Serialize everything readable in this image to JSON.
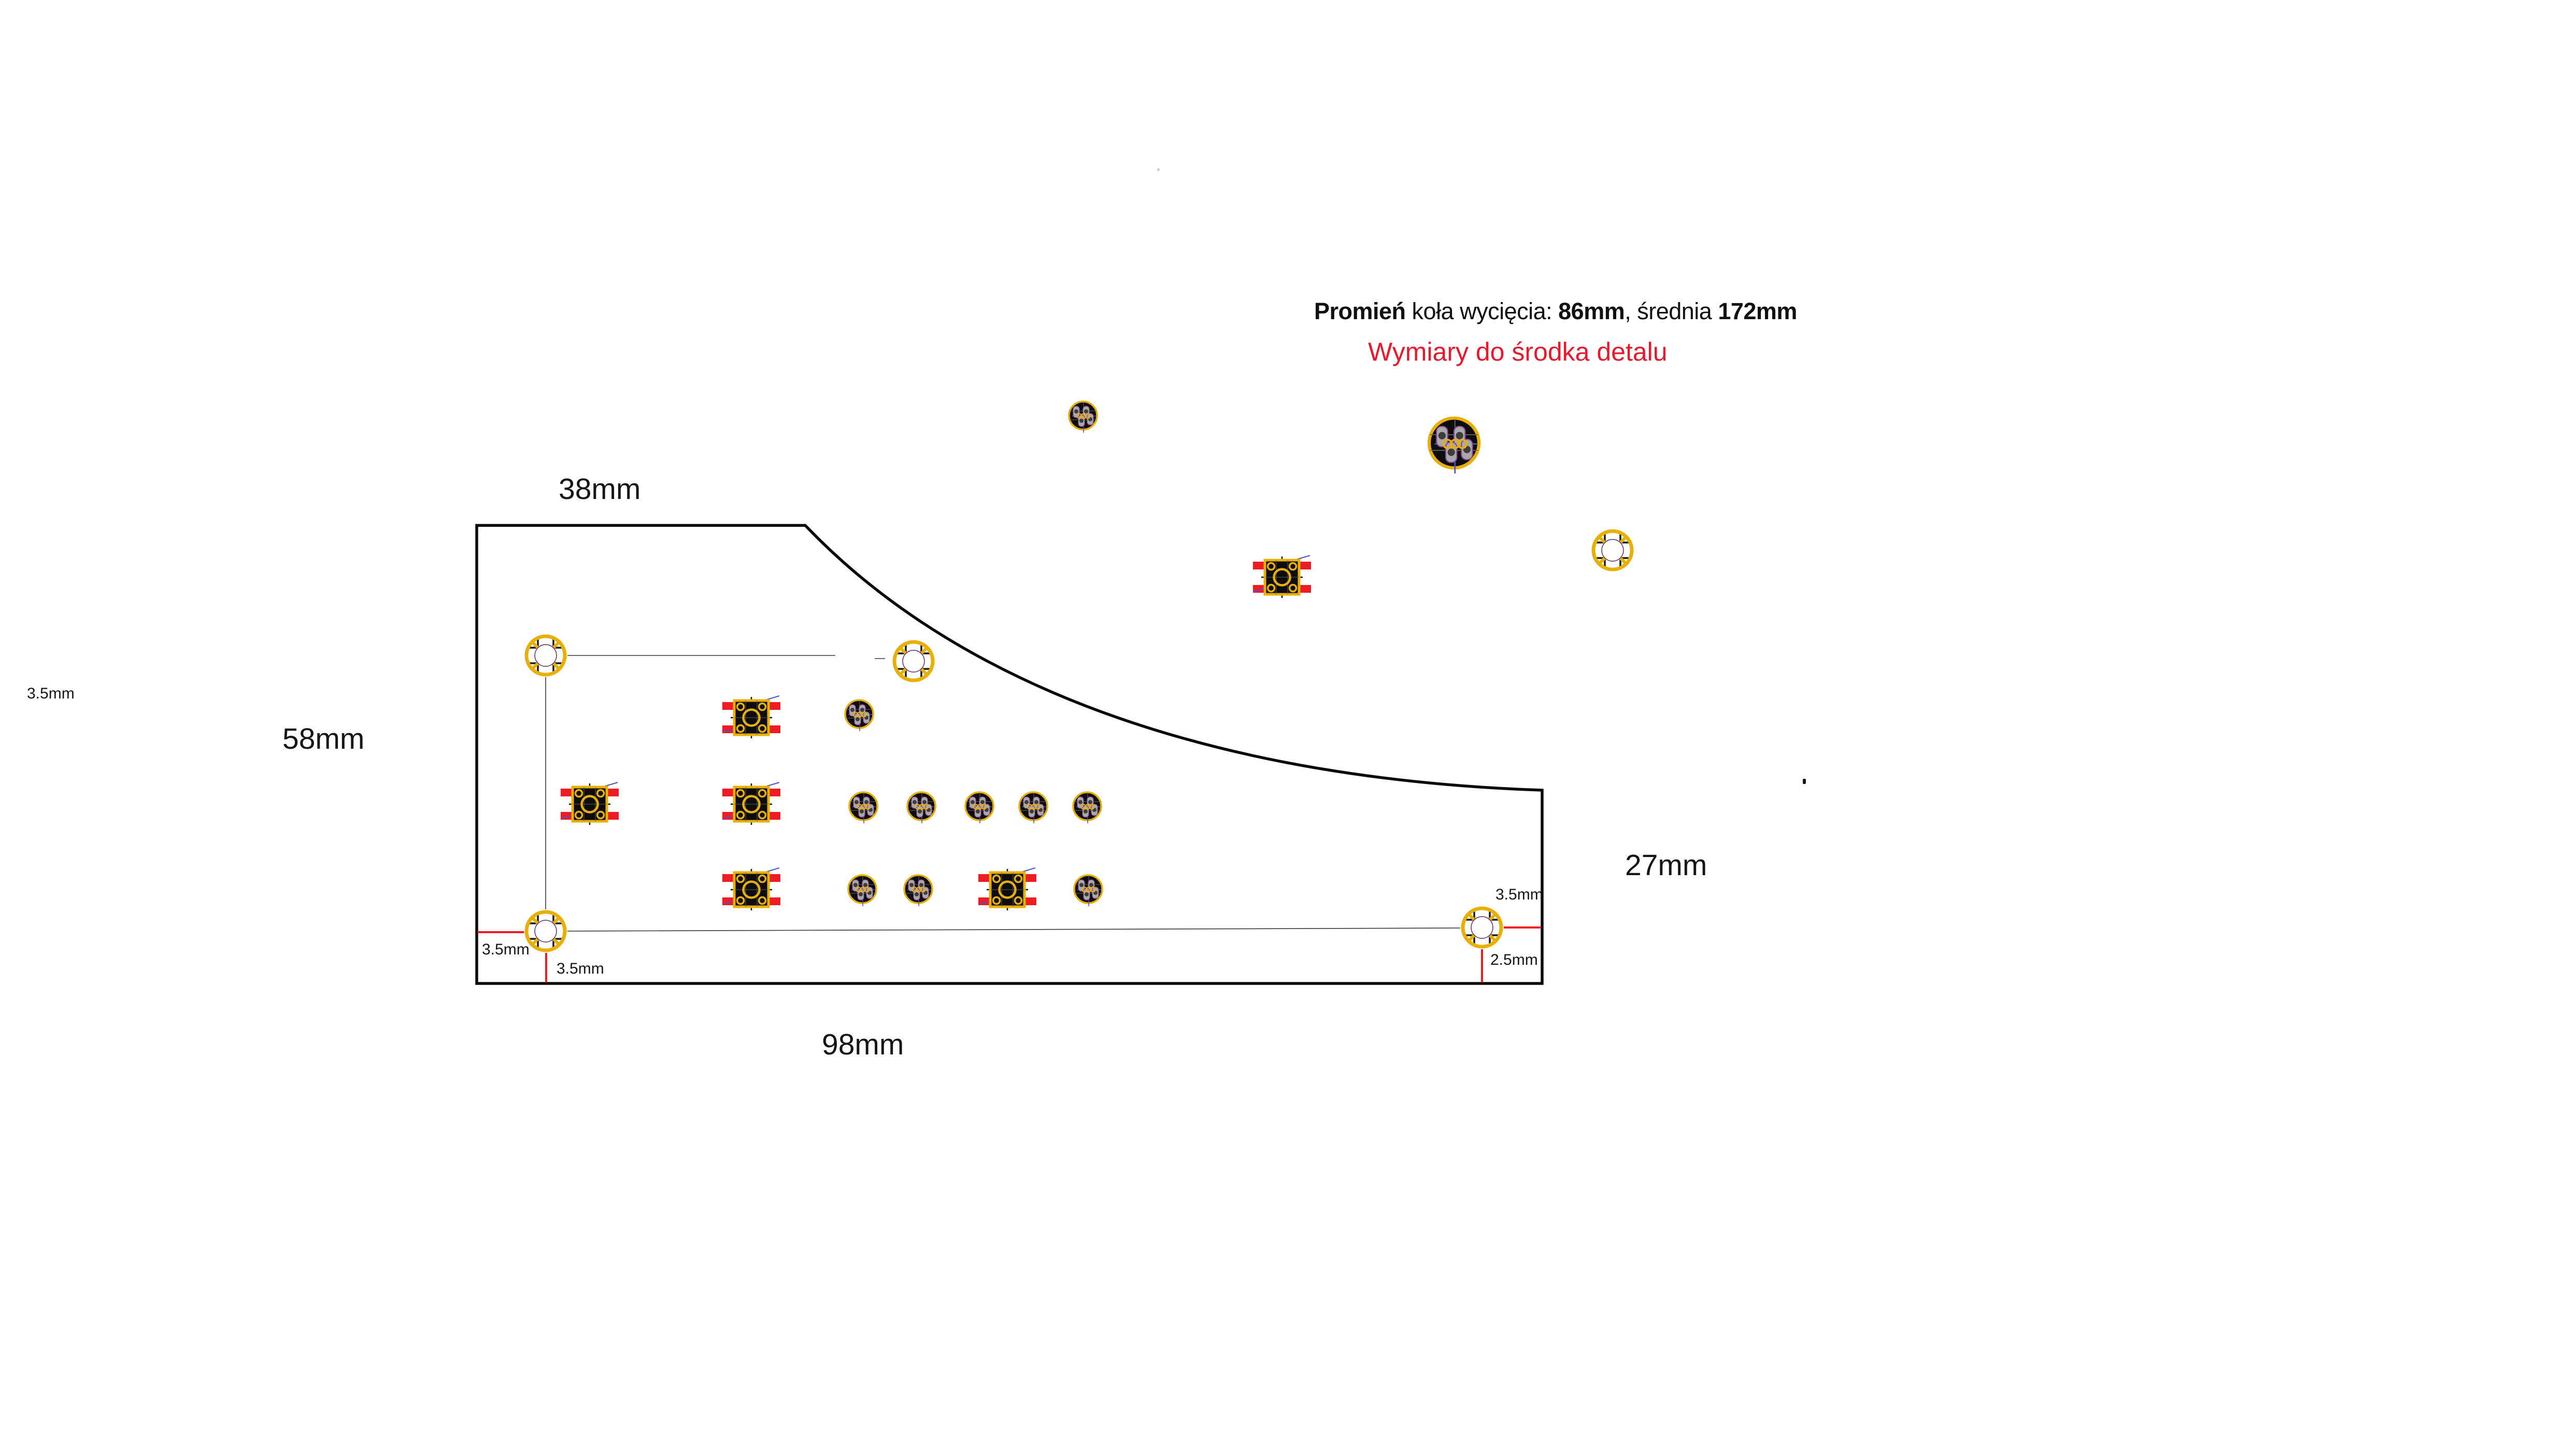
{
  "header": {
    "note_bold_1": "Promień",
    "note_text_1": " koła wycięcia: ",
    "note_bold_2": "86mm",
    "note_text_2": ", średnia ",
    "note_bold_3": "172mm",
    "subtitle": "Wymiary do środka detalu"
  },
  "dimensions": {
    "top_width": "38mm",
    "left_height": "58mm",
    "bottom_width": "98mm",
    "right_height": "27mm",
    "stray_left": "3.5mm",
    "hole_bl_from_left": "3.5mm",
    "hole_bl_from_bottom": "3.5mm",
    "hole_br_from_right": "3.5mm",
    "hole_br_from_bottom": "2.5mm"
  },
  "colors": {
    "board_outline": "#0a0a0a",
    "copper_gold": "#e8b004",
    "pad_red": "#ee1c24",
    "dimension_red": "#e8192c",
    "pad_gray": "#a9a9a9",
    "pad_outline_purple": "#8b4a9e",
    "ratsnest_blue": "#5050c8",
    "hole_drill_outline": "#5b2e6b"
  }
}
